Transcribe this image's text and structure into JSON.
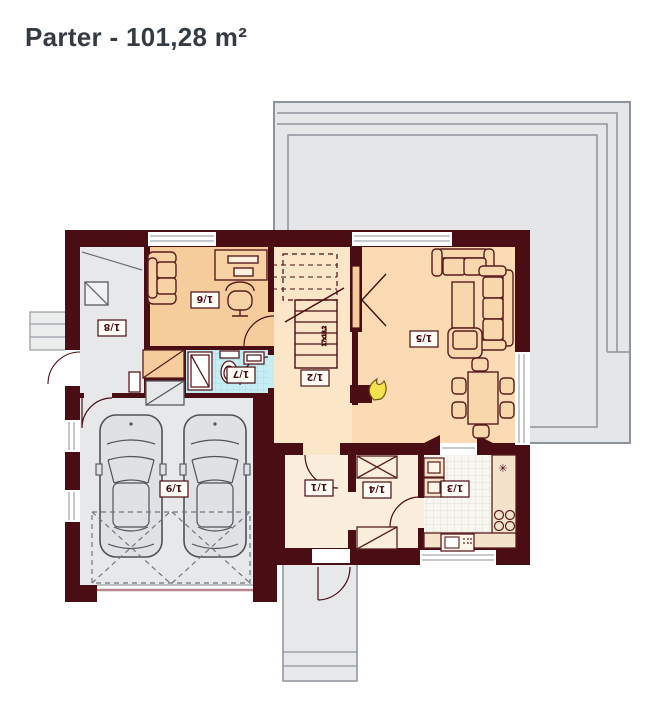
{
  "title": "Parter - 101,28 m²",
  "rooms": {
    "r11": "1/1",
    "r12": "1/2",
    "r13": "1/3",
    "r14": "1/4",
    "r15": "1/5",
    "r16": "1/6",
    "r17": "1/7",
    "r18": "1/8",
    "r19": "1/9"
  },
  "stairs": {
    "note": "17x18,2"
  },
  "colors": {
    "wall": "#4a0d13",
    "office_floor": "#f5cd9d",
    "living_floor": "#fadbb3",
    "hall_floor": "#fbe6c8",
    "hall_light_floor": "#fceedd",
    "gray_floor": "#e7e8ea",
    "terrace": "#e4e6e8",
    "bath_floor": "#c6edf3",
    "kitchen_floor": "#f7f6f1",
    "fireplace_flame": "#f2e24c",
    "garage_door_line": "#b7868e"
  }
}
